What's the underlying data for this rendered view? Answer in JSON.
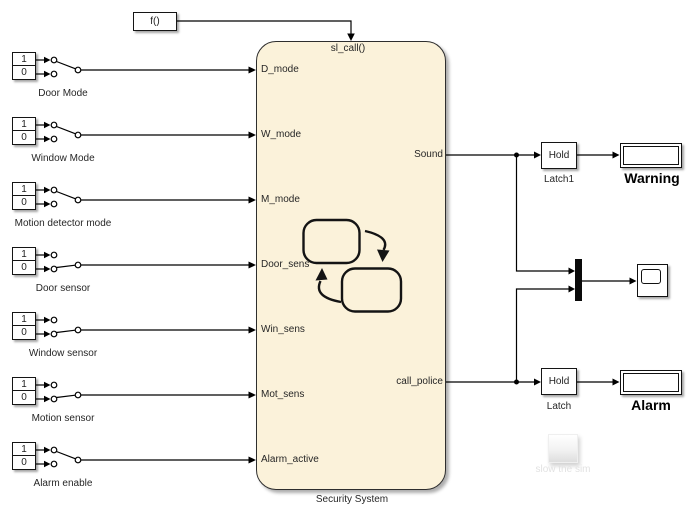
{
  "diagram": {
    "function_call_block": {
      "label": "f()"
    },
    "chart": {
      "trigger_label": "sl_call()",
      "name": "Security System",
      "inputs": [
        "D_mode",
        "W_mode",
        "M_mode",
        "Door_sens",
        "Win_sens",
        "Mot_sens",
        "Alarm_active"
      ],
      "outputs": [
        "Sound",
        "call_police"
      ]
    },
    "sources": [
      {
        "name": "Door Mode",
        "on_value": "1",
        "off_value": "0",
        "selected": "on"
      },
      {
        "name": "Window Mode",
        "on_value": "1",
        "off_value": "0",
        "selected": "on"
      },
      {
        "name": "Motion detector mode",
        "on_value": "1",
        "off_value": "0",
        "selected": "on"
      },
      {
        "name": "Door sensor",
        "on_value": "1",
        "off_value": "0",
        "selected": "off"
      },
      {
        "name": "Window sensor",
        "on_value": "1",
        "off_value": "0",
        "selected": "off"
      },
      {
        "name": "Motion sensor",
        "on_value": "1",
        "off_value": "0",
        "selected": "off"
      },
      {
        "name": "Alarm enable",
        "on_value": "1",
        "off_value": "0",
        "selected": "on"
      }
    ],
    "latches": [
      {
        "text": "Hold",
        "label": "Latch1"
      },
      {
        "text": "Hold",
        "label": "Latch"
      }
    ],
    "displays": [
      {
        "label": "Warning",
        "value": ""
      },
      {
        "label": "Alarm",
        "value": ""
      }
    ],
    "button": {
      "label": "slow the sim"
    },
    "colors": {
      "canvas": "#ffffff",
      "chart_fill": "#fbf2da",
      "wire": "#000000",
      "disabled_text": "#e2e2e2"
    }
  }
}
